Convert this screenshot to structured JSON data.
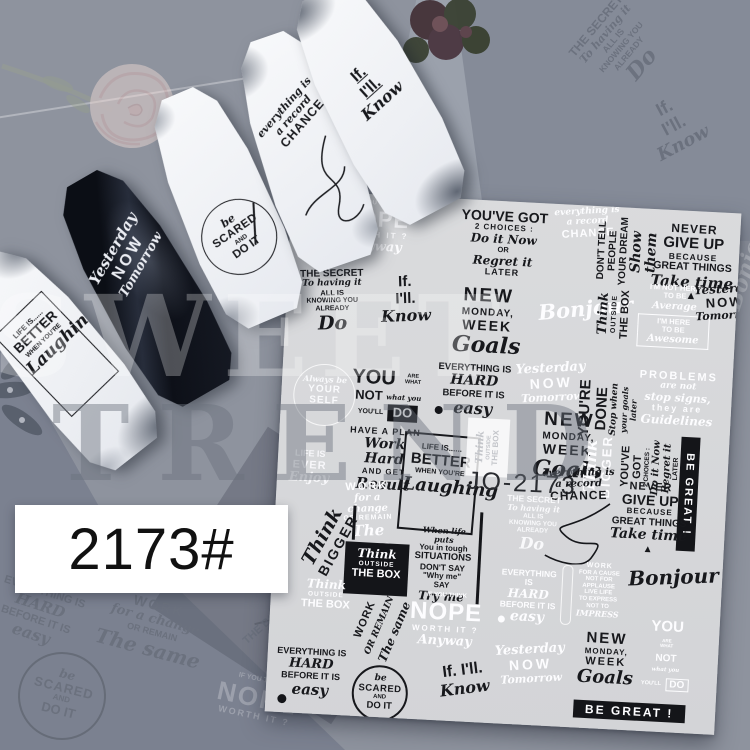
{
  "watermark": {
    "line1": "SWEET",
    "line2": "TREND"
  },
  "label": {
    "text": "2173#"
  },
  "sheet": {
    "code": "JO-2173"
  },
  "decals": {
    "nope": {
      "top": "IF YOU THINK",
      "word": "NOPE",
      "mid": "WORTH IT ?",
      "script": "Anyway"
    },
    "youve_got": {
      "l1": "YOU'VE GOT",
      "l2": "2 CHOICES :",
      "l3": "Do it Now",
      "l4": "OR",
      "l5": "Regret it",
      "l6": "LATER"
    },
    "never": {
      "l1": "NEVER",
      "l2": "GIVE UP",
      "l3": "BECAUSE",
      "l4": "GREAT THINGS",
      "l5": "Take time",
      "l6": "▲"
    },
    "new_monday": {
      "l1": "NEW",
      "l2": "MONDAY,",
      "l3": "WEEK",
      "l4": "Goals"
    },
    "dont_tell": {
      "l1": "DON'T TELL",
      "l2": "PEOPLE",
      "l3": "YOUR DREAM",
      "l4": "Show them"
    },
    "secret": {
      "l1": "THE SECRET",
      "l2": "To having it",
      "l3": "ALL IS",
      "l4": "KNOWING YOU",
      "l5": "ALREADY",
      "l6": "Do"
    },
    "if_know": {
      "l1": "If.",
      "l2": "I'll.",
      "l3": "Know"
    },
    "bonjour": {
      "l1": "Bonjour"
    },
    "think_box": {
      "l1": "Think",
      "l2": "OUTSIDE",
      "l3": "THE BOX"
    },
    "im_not_here": {
      "l1": "I'M NOT HERE",
      "l2": "TO BE",
      "l3": "Average",
      "l4": "I'M HERE",
      "l5": "TO BE",
      "l6": "Awesome"
    },
    "yesterday": {
      "l1": "Yesterday",
      "l2": "NOW",
      "l3": "Tomorrow"
    },
    "be_yourself": {
      "l1": "Always be",
      "l2": "YOUR",
      "l3": "SELF"
    },
    "you_are": {
      "l1": "YOU",
      "l1s": "ARE WHAT",
      "l2": "NOT",
      "l2s": "what you",
      "l3": "YOU'LL",
      "l3box": "DO"
    },
    "everything": {
      "l1": "EVERYTHING IS",
      "l2": "HARD",
      "l3": "BEFORE IT IS",
      "l4": "easy"
    },
    "youre_done": {
      "l1": "YOU'RE DONE",
      "l2": "Stop when",
      "l3": "your goals later"
    },
    "problems": {
      "l1": "PROBLEMS",
      "l2": "are not",
      "l3": "stop signs,",
      "l4": "they are",
      "l5": "Guidelines"
    },
    "life_ever": {
      "l1": "LIFE IS",
      "l2": "EVER",
      "l3": "Enjoy"
    },
    "have_plan": {
      "l1": "HAVE A PLAN",
      "l2": "Work Hard",
      "l3": "AND GET",
      "l4": "Result"
    },
    "life_better": {
      "l1": "LIFE IS......",
      "l2": "BETTER",
      "l3": "WHEN YOU'RE",
      "l4": "Laughing"
    },
    "think_bigger": {
      "l1": "Think",
      "l2": "BIGGER"
    },
    "be_great": {
      "l1": "BE GREAT !"
    },
    "work_same": {
      "l1": "WORK",
      "l2": "for a change",
      "l3": "OR REMAIN",
      "l4": "The same"
    },
    "chance": {
      "l1": "everything is",
      "l2": "a record",
      "l3": "CHANCE"
    },
    "situations": {
      "l1": "When life puts",
      "l2": "You in tough",
      "l3": "SITUATIONS",
      "l4": "DON'T SAY",
      "l5": "\"Why me\"",
      "l6": "SAY",
      "l7": "Try me"
    },
    "work_cause": {
      "l1": "WORK",
      "l2": "FOR A CAUSE",
      "l3": "NOT FOR",
      "l4": "APPLAUSE",
      "l5": "LIVE LIFE",
      "l6": "TO EXPRESS",
      "l7": "NOT TO",
      "l8": "IMPRESS"
    },
    "scared": {
      "l1": "be",
      "l2": "SCARED",
      "l3": "AND",
      "l4": "DO IT"
    }
  }
}
